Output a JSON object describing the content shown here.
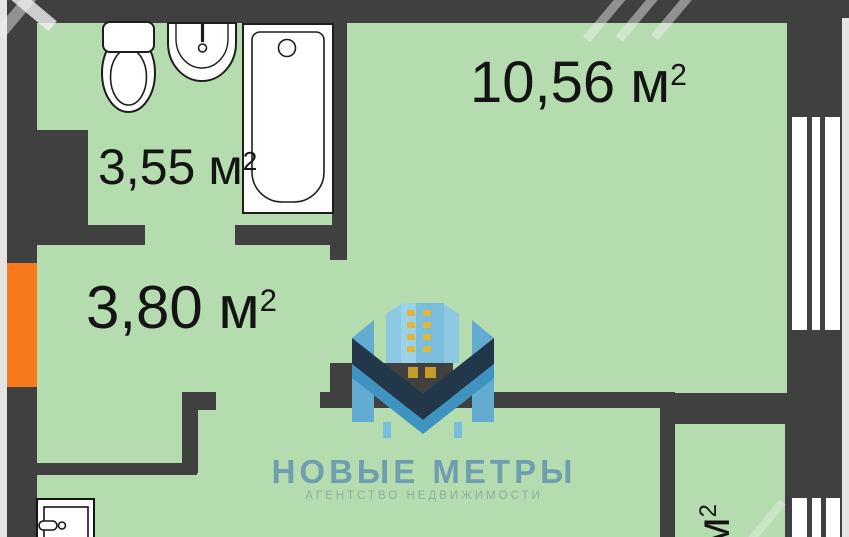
{
  "floorplan": {
    "rooms": {
      "bathroom": {
        "name": "bathroom",
        "area": "3,55",
        "unit": "м",
        "sup": "2"
      },
      "main_room": {
        "name": "main-room",
        "area": "10,56",
        "unit": "м",
        "sup": "2"
      },
      "hallway": {
        "name": "hallway",
        "area": "3,80",
        "unit": "м",
        "sup": "2"
      },
      "small_room": {
        "name": "small-room",
        "area": "",
        "unit": "м",
        "sup": "2"
      }
    },
    "fixtures": [
      "toilet",
      "sink",
      "bathtub",
      "washing-machine"
    ],
    "windows": [
      "main-room-window",
      "small-room-window"
    ],
    "entrance_marker": "orange-entrance-door",
    "colors": {
      "wall": "#404040",
      "floor": "#b5dcae",
      "outside": "#e4e4e4",
      "entrance_orange": "#f6791d",
      "window_white": "#ffffff",
      "label_text": "#141414",
      "logo_blue": "#64abd1",
      "logo_light_blue": "#8cc8e2",
      "logo_navy": "#22384a",
      "logo_yellow": "#dfb63c",
      "logo_title_color": "#6f9fae",
      "logo_subtitle_color": "#8fae9f"
    },
    "logo": {
      "title": "НОВЫЕ МЕТРЫ",
      "subtitle": "АГЕНТСТВО НЕДВИЖИМОСТИ",
      "mark": "m-buildings-monogram"
    }
  }
}
